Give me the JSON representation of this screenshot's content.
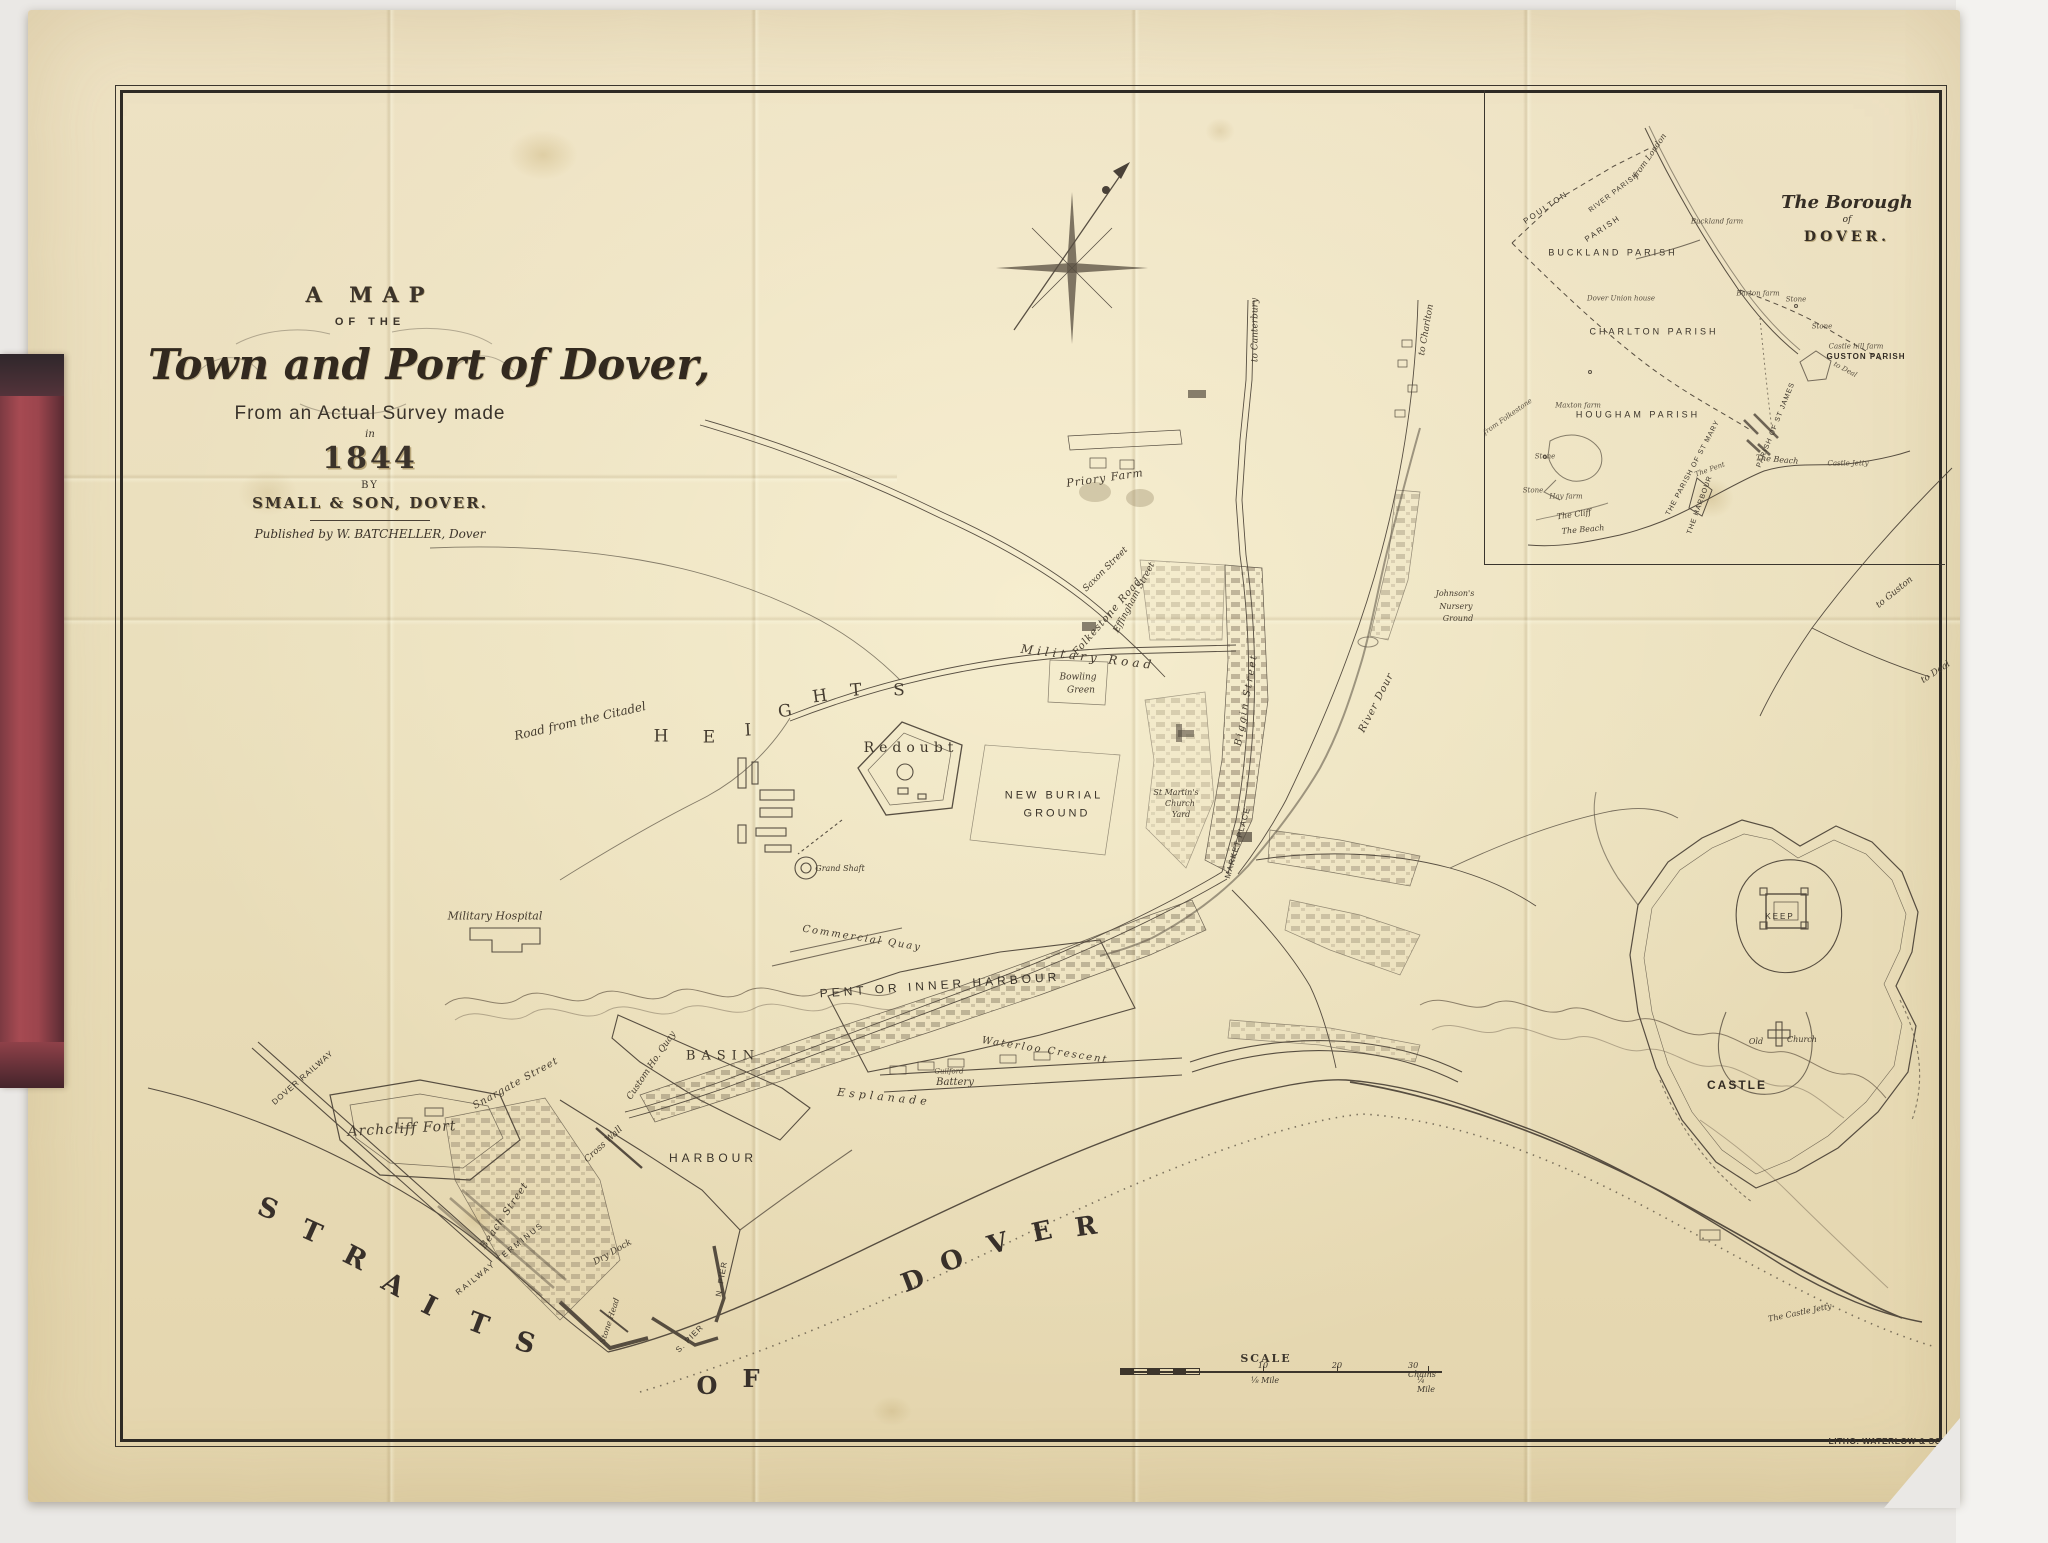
{
  "title_block": {
    "a_map": "A MAP",
    "of_the": "OF THE",
    "main": "Town and Port of Dover,",
    "survey": "From an Actual Survey made",
    "in": "in",
    "year": "1844",
    "by": "BY",
    "maker": "SMALL & SON, DOVER.",
    "published": "Published by W. BATCHELLER, Dover"
  },
  "inset": {
    "title1": "The Borough",
    "title2": "of",
    "title3": "DOVER."
  },
  "scale": {
    "title": "SCALE",
    "top": [
      "10",
      "20",
      "30 Chains"
    ],
    "bottom": [
      "⅛ Mile",
      "¼ Mile"
    ]
  },
  "imprint": "LITHO. WATERLOW & SONS.",
  "colors": {
    "paper": "#ebdfbd",
    "ink": "#3d362c",
    "spine_red": "#a6494f",
    "background": "#eae8e5"
  },
  "labels": [
    {
      "t": "S",
      "x": 268,
      "y": 1209,
      "r": 20,
      "s": 27,
      "c": "sea"
    },
    {
      "t": "T",
      "x": 311,
      "y": 1232,
      "r": 24,
      "s": 27,
      "c": "sea"
    },
    {
      "t": "R",
      "x": 355,
      "y": 1258,
      "r": 27,
      "s": 27,
      "c": "sea"
    },
    {
      "t": "A",
      "x": 393,
      "y": 1285,
      "r": 29,
      "s": 27,
      "c": "sea"
    },
    {
      "t": "I",
      "x": 429,
      "y": 1306,
      "r": 27,
      "s": 27,
      "c": "sea"
    },
    {
      "t": "T",
      "x": 478,
      "y": 1324,
      "r": 21,
      "s": 27,
      "c": "sea"
    },
    {
      "t": "S",
      "x": 525,
      "y": 1343,
      "r": 16,
      "s": 27,
      "c": "sea"
    },
    {
      "t": "O",
      "x": 707,
      "y": 1386,
      "r": 0,
      "s": 24,
      "c": "sea"
    },
    {
      "t": "F",
      "x": 751,
      "y": 1379,
      "r": 0,
      "s": 24,
      "c": "sea"
    },
    {
      "t": "D",
      "x": 913,
      "y": 1281,
      "r": -21,
      "s": 26,
      "c": "sea"
    },
    {
      "t": "O",
      "x": 952,
      "y": 1261,
      "r": -19,
      "s": 26,
      "c": "sea"
    },
    {
      "t": "V",
      "x": 998,
      "y": 1244,
      "r": -16,
      "s": 26,
      "c": "sea"
    },
    {
      "t": "E",
      "x": 1042,
      "y": 1232,
      "r": -12,
      "s": 26,
      "c": "sea"
    },
    {
      "t": "R",
      "x": 1086,
      "y": 1227,
      "r": -8,
      "s": 26,
      "c": "sea"
    },
    {
      "t": "H",
      "x": 661,
      "y": 737,
      "r": 0,
      "s": 17,
      "c": "hills"
    },
    {
      "t": "E",
      "x": 709,
      "y": 738,
      "r": 0,
      "s": 17,
      "c": "hills"
    },
    {
      "t": "I",
      "x": 748,
      "y": 731,
      "r": -3,
      "s": 17,
      "c": "hills"
    },
    {
      "t": "G",
      "x": 785,
      "y": 712,
      "r": -8,
      "s": 17,
      "c": "hills"
    },
    {
      "t": "H",
      "x": 820,
      "y": 697,
      "r": -8,
      "s": 17,
      "c": "hills"
    },
    {
      "t": "T",
      "x": 856,
      "y": 691,
      "r": -5,
      "s": 17,
      "c": "hills"
    },
    {
      "t": "S",
      "x": 899,
      "y": 691,
      "r": 0,
      "s": 17,
      "c": "hills"
    },
    {
      "t": "PENT OR INNER HARBOUR",
      "x": 940,
      "y": 985,
      "r": -4,
      "s": 12,
      "ls": 4,
      "c": "sans"
    },
    {
      "t": "BASIN",
      "x": 723,
      "y": 1056,
      "r": 0,
      "s": 13,
      "ls": 6,
      "c": "caps"
    },
    {
      "t": "HARBOUR",
      "x": 713,
      "y": 1158,
      "r": 0,
      "s": 12,
      "ls": 4,
      "c": "sans"
    },
    {
      "t": "Esplanade",
      "x": 884,
      "y": 1097,
      "r": 6,
      "s": 11,
      "ls": 4,
      "c": "ital"
    },
    {
      "t": "Guilford",
      "x": 949,
      "y": 1072,
      "r": 0,
      "s": 7,
      "c": "tiny"
    },
    {
      "t": "Battery",
      "x": 955,
      "y": 1083,
      "r": 0,
      "s": 10,
      "c": "ital"
    },
    {
      "t": "Waterloo Crescent",
      "x": 1045,
      "y": 1051,
      "r": 9,
      "s": 10,
      "ls": 2,
      "c": "ital"
    },
    {
      "t": "Commercial Quay",
      "x": 862,
      "y": 939,
      "r": 9,
      "s": 10,
      "ls": 2,
      "c": "ital"
    },
    {
      "t": "Custom Ho. Quay",
      "x": 652,
      "y": 1066,
      "r": -56,
      "s": 9,
      "c": "ital"
    },
    {
      "t": "Cross Wall",
      "x": 604,
      "y": 1145,
      "r": -43,
      "s": 9,
      "c": "ital"
    },
    {
      "t": "Snargate Street",
      "x": 516,
      "y": 1084,
      "r": -29,
      "s": 10,
      "ls": 1,
      "c": "ital"
    },
    {
      "t": "Beach Street",
      "x": 505,
      "y": 1216,
      "r": -56,
      "s": 10,
      "ls": 1,
      "c": "ital"
    },
    {
      "t": "RAILWAY TERMINUS",
      "x": 500,
      "y": 1259,
      "r": -39,
      "s": 8,
      "ls": 2,
      "c": "sans"
    },
    {
      "t": "DOVER RAILWAY",
      "x": 303,
      "y": 1078,
      "r": -41,
      "s": 8,
      "ls": 1,
      "c": "sans"
    },
    {
      "t": "Dry Dock",
      "x": 613,
      "y": 1253,
      "r": -30,
      "s": 9,
      "c": "ital"
    },
    {
      "t": "Stone Head",
      "x": 610,
      "y": 1321,
      "r": -72,
      "s": 8,
      "c": "ital"
    },
    {
      "t": "N. PIER",
      "x": 722,
      "y": 1279,
      "r": -80,
      "s": 8,
      "ls": 1,
      "c": "sans"
    },
    {
      "t": "S. PIER",
      "x": 690,
      "y": 1339,
      "r": -45,
      "s": 8,
      "ls": 1,
      "c": "sans"
    },
    {
      "t": "Archcliff Fort",
      "x": 402,
      "y": 1129,
      "r": -3,
      "s": 14,
      "ls": 1,
      "c": "ital"
    },
    {
      "t": "Military Hospital",
      "x": 495,
      "y": 916,
      "r": 0,
      "s": 11,
      "c": "ital"
    },
    {
      "t": "Grand Shaft",
      "x": 840,
      "y": 869,
      "r": 0,
      "s": 8,
      "c": "ital"
    },
    {
      "t": "Redoubt",
      "x": 911,
      "y": 748,
      "r": 0,
      "s": 14,
      "ls": 5,
      "c": "caps"
    },
    {
      "t": "Road from the Citadel",
      "x": 580,
      "y": 721,
      "r": -13,
      "s": 12,
      "c": "ital"
    },
    {
      "t": "Military Road",
      "x": 1088,
      "y": 657,
      "r": 7,
      "s": 12,
      "ls": 4,
      "c": "ital"
    },
    {
      "t": "Folkestone Road",
      "x": 1108,
      "y": 617,
      "r": -49,
      "s": 10,
      "ls": 1,
      "c": "ital"
    },
    {
      "t": "Effingham Street",
      "x": 1135,
      "y": 598,
      "r": -62,
      "s": 9,
      "c": "ital"
    },
    {
      "t": "Saxon Street",
      "x": 1106,
      "y": 570,
      "r": -45,
      "s": 9,
      "c": "ital"
    },
    {
      "t": "Biggin Street",
      "x": 1247,
      "y": 700,
      "r": -80,
      "s": 10,
      "ls": 2,
      "c": "ital"
    },
    {
      "t": "MARKET PLACE",
      "x": 1238,
      "y": 843,
      "r": -74,
      "s": 8,
      "ls": 1,
      "c": "sans"
    },
    {
      "t": "St Martin's",
      "x": 1176,
      "y": 793,
      "r": 0,
      "s": 8,
      "c": "ital"
    },
    {
      "t": "Church",
      "x": 1180,
      "y": 804,
      "r": 0,
      "s": 8,
      "c": "ital"
    },
    {
      "t": "Yard",
      "x": 1181,
      "y": 815,
      "r": 0,
      "s": 8,
      "c": "ital"
    },
    {
      "t": "NEW BURIAL",
      "x": 1054,
      "y": 796,
      "r": 0,
      "s": 11,
      "ls": 3,
      "c": "sans"
    },
    {
      "t": "GROUND",
      "x": 1057,
      "y": 814,
      "r": 0,
      "s": 11,
      "ls": 3,
      "c": "sans"
    },
    {
      "t": "Bowling",
      "x": 1078,
      "y": 678,
      "r": 0,
      "s": 9,
      "c": "ital"
    },
    {
      "t": "Green",
      "x": 1081,
      "y": 691,
      "r": 0,
      "s": 9,
      "c": "ital"
    },
    {
      "t": "Priory Farm",
      "x": 1105,
      "y": 478,
      "r": -8,
      "s": 11,
      "ls": 1,
      "c": "ital"
    },
    {
      "t": "River Dour",
      "x": 1377,
      "y": 703,
      "r": -63,
      "s": 10,
      "ls": 1,
      "c": "ital"
    },
    {
      "t": "Johnson's",
      "x": 1455,
      "y": 594,
      "r": 0,
      "s": 8,
      "c": "ital"
    },
    {
      "t": "Nursery",
      "x": 1456,
      "y": 607,
      "r": 0,
      "s": 8,
      "c": "ital"
    },
    {
      "t": "Ground",
      "x": 1458,
      "y": 619,
      "r": 0,
      "s": 8,
      "c": "ital"
    },
    {
      "t": "to Canterbury",
      "x": 1256,
      "y": 330,
      "r": -90,
      "s": 9,
      "c": "ital"
    },
    {
      "t": "to Charlton",
      "x": 1427,
      "y": 330,
      "r": -80,
      "s": 9,
      "c": "ital"
    },
    {
      "t": "to Guston",
      "x": 1895,
      "y": 593,
      "r": -39,
      "s": 9,
      "c": "ital"
    },
    {
      "t": "to Deal",
      "x": 1936,
      "y": 673,
      "r": -33,
      "s": 9,
      "c": "ital"
    },
    {
      "t": "CASTLE",
      "x": 1737,
      "y": 1085,
      "r": 0,
      "s": 12,
      "ls": 2,
      "c": "sansbold"
    },
    {
      "t": "KEEP",
      "x": 1780,
      "y": 917,
      "r": 0,
      "s": 8,
      "ls": 2,
      "c": "sans"
    },
    {
      "t": "Old",
      "x": 1756,
      "y": 1042,
      "r": 0,
      "s": 8,
      "c": "ital"
    },
    {
      "t": "Church",
      "x": 1802,
      "y": 1040,
      "r": 0,
      "s": 8,
      "c": "ital"
    },
    {
      "t": "The Castle Jetty",
      "x": 1800,
      "y": 1313,
      "r": -12,
      "s": 8,
      "c": "ital"
    },
    {
      "t": "POULTON",
      "x": 1546,
      "y": 208,
      "r": -34,
      "s": 8,
      "ls": 2,
      "c": "sans"
    },
    {
      "t": "PARISH",
      "x": 1603,
      "y": 229,
      "r": -34,
      "s": 8,
      "ls": 2,
      "c": "sans"
    },
    {
      "t": "RIVER PARISH",
      "x": 1614,
      "y": 193,
      "r": -37,
      "s": 7,
      "ls": 1,
      "c": "sans"
    },
    {
      "t": "from London",
      "x": 1650,
      "y": 156,
      "r": -55,
      "s": 8,
      "c": "ital"
    },
    {
      "t": "BUCKLAND PARISH",
      "x": 1613,
      "y": 253,
      "r": 0,
      "s": 9,
      "ls": 3,
      "c": "sans"
    },
    {
      "t": "Buckland farm",
      "x": 1717,
      "y": 222,
      "r": 0,
      "s": 7,
      "c": "tiny"
    },
    {
      "t": "Dover Union house",
      "x": 1621,
      "y": 299,
      "r": 0,
      "s": 7,
      "c": "tiny"
    },
    {
      "t": "CHARLTON PARISH",
      "x": 1654,
      "y": 332,
      "r": 0,
      "s": 9,
      "ls": 3,
      "c": "sans"
    },
    {
      "t": "Barton farm",
      "x": 1758,
      "y": 294,
      "r": 0,
      "s": 7,
      "c": "tiny"
    },
    {
      "t": "Stone",
      "x": 1796,
      "y": 300,
      "r": 0,
      "s": 7,
      "c": "tiny"
    },
    {
      "t": "Stone",
      "x": 1822,
      "y": 327,
      "r": 0,
      "s": 7,
      "c": "tiny"
    },
    {
      "t": "Castle hill farm",
      "x": 1856,
      "y": 347,
      "r": 0,
      "s": 7,
      "c": "tiny"
    },
    {
      "t": "GUSTON PARISH",
      "x": 1866,
      "y": 357,
      "r": 0,
      "s": 8,
      "ls": 1,
      "c": "sansbold"
    },
    {
      "t": "to Deal",
      "x": 1845,
      "y": 370,
      "r": 28,
      "s": 7,
      "c": "tiny"
    },
    {
      "t": "HOUGHAM PARISH",
      "x": 1638,
      "y": 415,
      "r": 0,
      "s": 9,
      "ls": 3,
      "c": "sans"
    },
    {
      "t": "Maxton farm",
      "x": 1578,
      "y": 406,
      "r": 0,
      "s": 7,
      "c": "tiny"
    },
    {
      "t": "from Folkestone",
      "x": 1508,
      "y": 417,
      "r": -35,
      "s": 7,
      "c": "tiny"
    },
    {
      "t": "Stone",
      "x": 1545,
      "y": 457,
      "r": 0,
      "s": 7,
      "c": "tiny"
    },
    {
      "t": "Stone",
      "x": 1533,
      "y": 491,
      "r": 0,
      "s": 7,
      "c": "tiny"
    },
    {
      "t": "Hay farm",
      "x": 1566,
      "y": 497,
      "r": 0,
      "s": 7,
      "c": "tiny"
    },
    {
      "t": "The Cliff",
      "x": 1574,
      "y": 515,
      "r": -8,
      "s": 8,
      "c": "ital"
    },
    {
      "t": "The Beach",
      "x": 1583,
      "y": 530,
      "r": -5,
      "s": 8,
      "c": "ital"
    },
    {
      "t": "THE PARISH OF ST MARY",
      "x": 1693,
      "y": 468,
      "r": -62,
      "s": 7,
      "ls": 1,
      "c": "sans"
    },
    {
      "t": "PARISH OF ST JAMES",
      "x": 1776,
      "y": 425,
      "r": -68,
      "s": 7,
      "ls": 1,
      "c": "sans"
    },
    {
      "t": "The Pent",
      "x": 1710,
      "y": 470,
      "r": -20,
      "s": 7,
      "c": "tiny"
    },
    {
      "t": "THE HARBOUR",
      "x": 1700,
      "y": 505,
      "r": -70,
      "s": 7,
      "ls": 1,
      "c": "sans"
    },
    {
      "t": "The Beach",
      "x": 1777,
      "y": 460,
      "r": 5,
      "s": 8,
      "c": "ital"
    },
    {
      "t": "Castle Jetty",
      "x": 1848,
      "y": 464,
      "r": 0,
      "s": 7,
      "c": "tiny"
    }
  ]
}
